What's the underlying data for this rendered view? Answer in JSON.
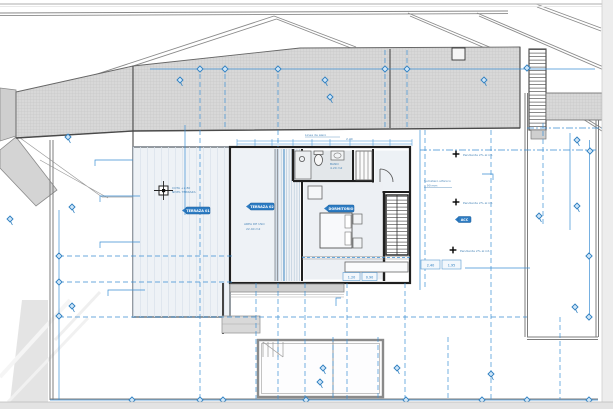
{
  "viewer": {
    "frame_color": "#e8e8e8",
    "paper_color": "#ffffff"
  },
  "colors": {
    "accent_blue": "#2e7fc0",
    "marker_fill": "#cfe6f8",
    "roof_gray": "#d8d8d8",
    "wall_dark": "#1f1f1f",
    "line_gray": "#8a8a8a"
  },
  "icons": {
    "diamond_marker": "diamond-marker",
    "pin_marker": "pin-marker",
    "benchmark": "benchmark-icon",
    "cross_marker": "cross-marker"
  },
  "tags": {
    "terrace": "TERRAZA 01",
    "deck": "TERRAZA 02",
    "bedroom": "DORMITORIO",
    "access": "ACC"
  },
  "notes": {
    "area_line1": "AREA DE USO",
    "area_line2": "22.40 m2",
    "slope1": "Pendiente 2% al int.",
    "slope2": "Pendiente 2% al int.",
    "slope3": "Pendiente 2% al int.",
    "drain_line1": "Sumidero sifonico",
    "drain_line2": "o 90 mm",
    "eave": "Linea de alero",
    "eave_dim": "2.40",
    "bath_line1": "BANO",
    "bath_line2": "4.20 m2",
    "bench_line1": "COTA +2.80",
    "bench_line2": "NIVEL TERRAZA"
  },
  "dim_boxes": {
    "b1": "2.40",
    "b2": "1.95",
    "b3": "1.20",
    "b4": "0.90"
  }
}
